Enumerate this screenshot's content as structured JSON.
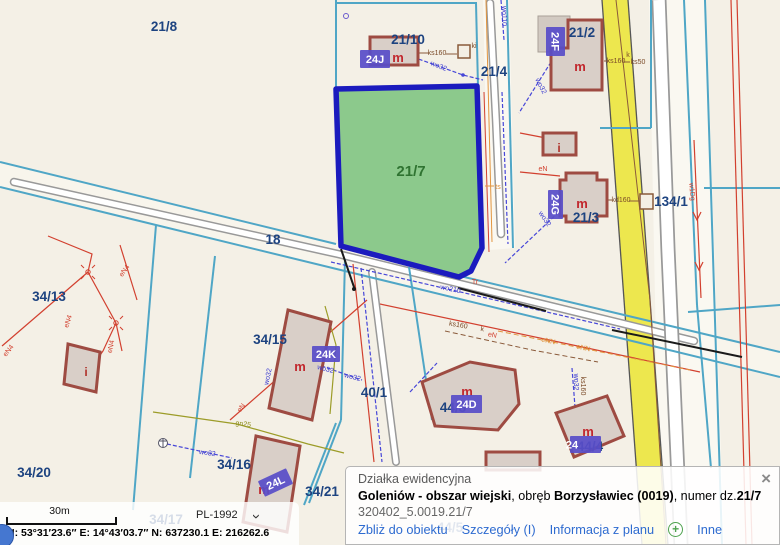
{
  "colors": {
    "background": "#F4F0E6",
    "parcel_label": "#1D4380",
    "selected_parcel_fill": "#8CC98C",
    "selected_parcel_stroke": "#1B1BBE",
    "address_label_bg": "#584EC8",
    "building_stroke": "#9E4B42",
    "building_fill": "#D9CFC8",
    "boundary_cyan": "#4FA6C6",
    "road_yellow": "#EDE74E",
    "link_blue": "#2E6BD0"
  },
  "popup": {
    "title": "Działka ewidencyjna",
    "region_bold": "Goleniów - obszar wiejski",
    "obreb_pre": ", obręb ",
    "obreb_bold": "Borzysławiec (0019)",
    "numer_pre": ", numer dz.",
    "numer_bold": "21/7",
    "ident": "320402_5.0019.21/7",
    "links": {
      "zoom": "Zbliż do obiektu",
      "details": "Szczegóły (I)",
      "plan": "Informacja z planu",
      "other": "Inne"
    },
    "plus_icon": "+",
    "close_icon": "×"
  },
  "statusbar": {
    "scale": "30m",
    "crs": "PL-1992",
    "chevron_icon": "›",
    "coords": "N: 53°31′23.6″   E: 14°43′03.7″   N: 637230.1   E: 216262.6"
  },
  "map": {
    "labels": [
      {
        "t": "21/8",
        "x": 164,
        "y": 31,
        "c": "p"
      },
      {
        "t": "21/10",
        "x": 408,
        "y": 44,
        "c": "p"
      },
      {
        "t": "21/4",
        "x": 494,
        "y": 76,
        "c": "p"
      },
      {
        "t": "21/2",
        "x": 582,
        "y": 37,
        "c": "p"
      },
      {
        "t": "21/3",
        "x": 586,
        "y": 222,
        "c": "p"
      },
      {
        "t": "134/1",
        "x": 671,
        "y": 206,
        "c": "p"
      },
      {
        "t": "34/13",
        "x": 49,
        "y": 301,
        "c": "p"
      },
      {
        "t": "18",
        "x": 273,
        "y": 244,
        "c": "p"
      },
      {
        "t": "34/15",
        "x": 270,
        "y": 344,
        "c": "p"
      },
      {
        "t": "40/1",
        "x": 374,
        "y": 397,
        "c": "p"
      },
      {
        "t": "44/3",
        "x": 453,
        "y": 412,
        "c": "p"
      },
      {
        "t": "44/4",
        "x": 590,
        "y": 451,
        "c": "p"
      },
      {
        "t": "34/20",
        "x": 34,
        "y": 477,
        "c": "p"
      },
      {
        "t": "34/16",
        "x": 234,
        "y": 469,
        "c": "p"
      },
      {
        "t": "34/21",
        "x": 322,
        "y": 496,
        "c": "p"
      },
      {
        "t": "34/17",
        "x": 166,
        "y": 524,
        "c": "p"
      },
      {
        "t": "44/5",
        "x": 450,
        "y": 532,
        "c": "p"
      },
      {
        "t": "21/7",
        "x": 411,
        "y": 176,
        "c": "pg"
      },
      {
        "t": "m",
        "x": 398,
        "y": 62,
        "c": "m"
      },
      {
        "t": "m",
        "x": 580,
        "y": 71,
        "c": "m"
      },
      {
        "t": "m",
        "x": 582,
        "y": 208,
        "c": "m"
      },
      {
        "t": "m",
        "x": 300,
        "y": 371,
        "c": "m"
      },
      {
        "t": "m",
        "x": 264,
        "y": 494,
        "c": "m"
      },
      {
        "t": "m",
        "x": 467,
        "y": 396,
        "c": "m"
      },
      {
        "t": "m",
        "x": 588,
        "y": 436,
        "c": "m"
      },
      {
        "t": "i",
        "x": 559,
        "y": 152,
        "c": "i"
      },
      {
        "t": "i",
        "x": 86,
        "y": 376,
        "c": "i"
      },
      {
        "t": "ki",
        "x": 474,
        "y": 48,
        "c": "ub"
      },
      {
        "t": "ks160",
        "x": 437,
        "y": 55,
        "c": "ub"
      },
      {
        "t": "ks160",
        "x": 616,
        "y": 63,
        "c": "ub"
      },
      {
        "t": "k",
        "x": 628,
        "y": 57,
        "c": "ub"
      },
      {
        "t": "ks50",
        "x": 638,
        "y": 64,
        "c": "ub"
      },
      {
        "t": "kd160",
        "x": 621,
        "y": 202,
        "c": "ub"
      },
      {
        "t": "ks160",
        "x": 581,
        "y": 386,
        "c": "ub",
        "r": 90
      },
      {
        "t": "ks160",
        "x": 458,
        "y": 327,
        "c": "ub",
        "r": 10
      },
      {
        "t": "k",
        "x": 482,
        "y": 331,
        "c": "ub",
        "r": 10
      },
      {
        "t": "wo32",
        "x": 438,
        "y": 68,
        "c": "ul",
        "r": 22
      },
      {
        "t": "wo32",
        "x": 539,
        "y": 87,
        "c": "ul",
        "r": 62
      },
      {
        "t": "wo32",
        "x": 543,
        "y": 220,
        "c": "ul",
        "r": 55
      },
      {
        "t": "wo32",
        "x": 270,
        "y": 377,
        "c": "ul",
        "r": -78
      },
      {
        "t": "wo32",
        "x": 207,
        "y": 455,
        "c": "ul",
        "r": 8
      },
      {
        "t": "wo32",
        "x": 325,
        "y": 371,
        "c": "ul",
        "r": 14
      },
      {
        "t": "wo32",
        "x": 352,
        "y": 379,
        "c": "ul",
        "r": 14
      },
      {
        "t": "wo210",
        "x": 450,
        "y": 291,
        "c": "ul",
        "r": 12
      },
      {
        "t": "wo110",
        "x": 502,
        "y": 16,
        "c": "ul",
        "r": 90
      },
      {
        "t": "wo32",
        "x": 574,
        "y": 382,
        "c": "ul",
        "r": 90
      },
      {
        "t": "eN4",
        "x": 10,
        "y": 352,
        "c": "ur",
        "r": -52
      },
      {
        "t": "eN4",
        "x": 70,
        "y": 322,
        "c": "ur",
        "r": -72
      },
      {
        "t": "eN4",
        "x": 126,
        "y": 272,
        "c": "ur",
        "r": -55
      },
      {
        "t": "eN4",
        "x": 113,
        "y": 347,
        "c": "ur",
        "r": -78
      },
      {
        "t": "eN",
        "x": 543,
        "y": 171,
        "c": "ur"
      },
      {
        "t": "eN",
        "x": 492,
        "y": 337,
        "c": "ur",
        "r": 12
      },
      {
        "t": "eN",
        "x": 243,
        "y": 409,
        "c": "ur",
        "r": -55
      },
      {
        "t": "Tr",
        "x": 475,
        "y": 284,
        "c": "ur"
      },
      {
        "t": "w1Dg",
        "x": 690,
        "y": 192,
        "c": "ur",
        "r": 85
      },
      {
        "t": "ts",
        "x": 498,
        "y": 189,
        "c": "uo"
      },
      {
        "t": "eNN",
        "x": 548,
        "y": 343,
        "c": "uo",
        "r": 12
      },
      {
        "t": "eNN",
        "x": 583,
        "y": 350,
        "c": "uo",
        "r": 12
      },
      {
        "t": "gn25",
        "x": 243,
        "y": 426,
        "c": "uv",
        "r": 8
      }
    ],
    "addr": [
      {
        "t": "24J",
        "x": 360,
        "y": 50,
        "w": 30,
        "h": 18,
        "r": 0
      },
      {
        "t": "24F",
        "x": 546,
        "y": 27,
        "w": 19,
        "h": 29,
        "r": 90
      },
      {
        "t": "24G",
        "x": 548,
        "y": 190,
        "w": 15,
        "h": 29,
        "r": 90
      },
      {
        "t": "24K",
        "x": 312,
        "y": 346,
        "w": 28,
        "h": 16,
        "r": 0
      },
      {
        "t": "24L",
        "x": 260,
        "y": 474,
        "w": 31,
        "h": 17,
        "r": -25
      },
      {
        "t": "24D",
        "x": 451,
        "y": 395,
        "w": 31,
        "h": 18,
        "r": 0
      },
      {
        "t": "24",
        "x": 570,
        "y": 436,
        "w": 31,
        "h": 17,
        "r": 0,
        "a": "s"
      }
    ]
  }
}
